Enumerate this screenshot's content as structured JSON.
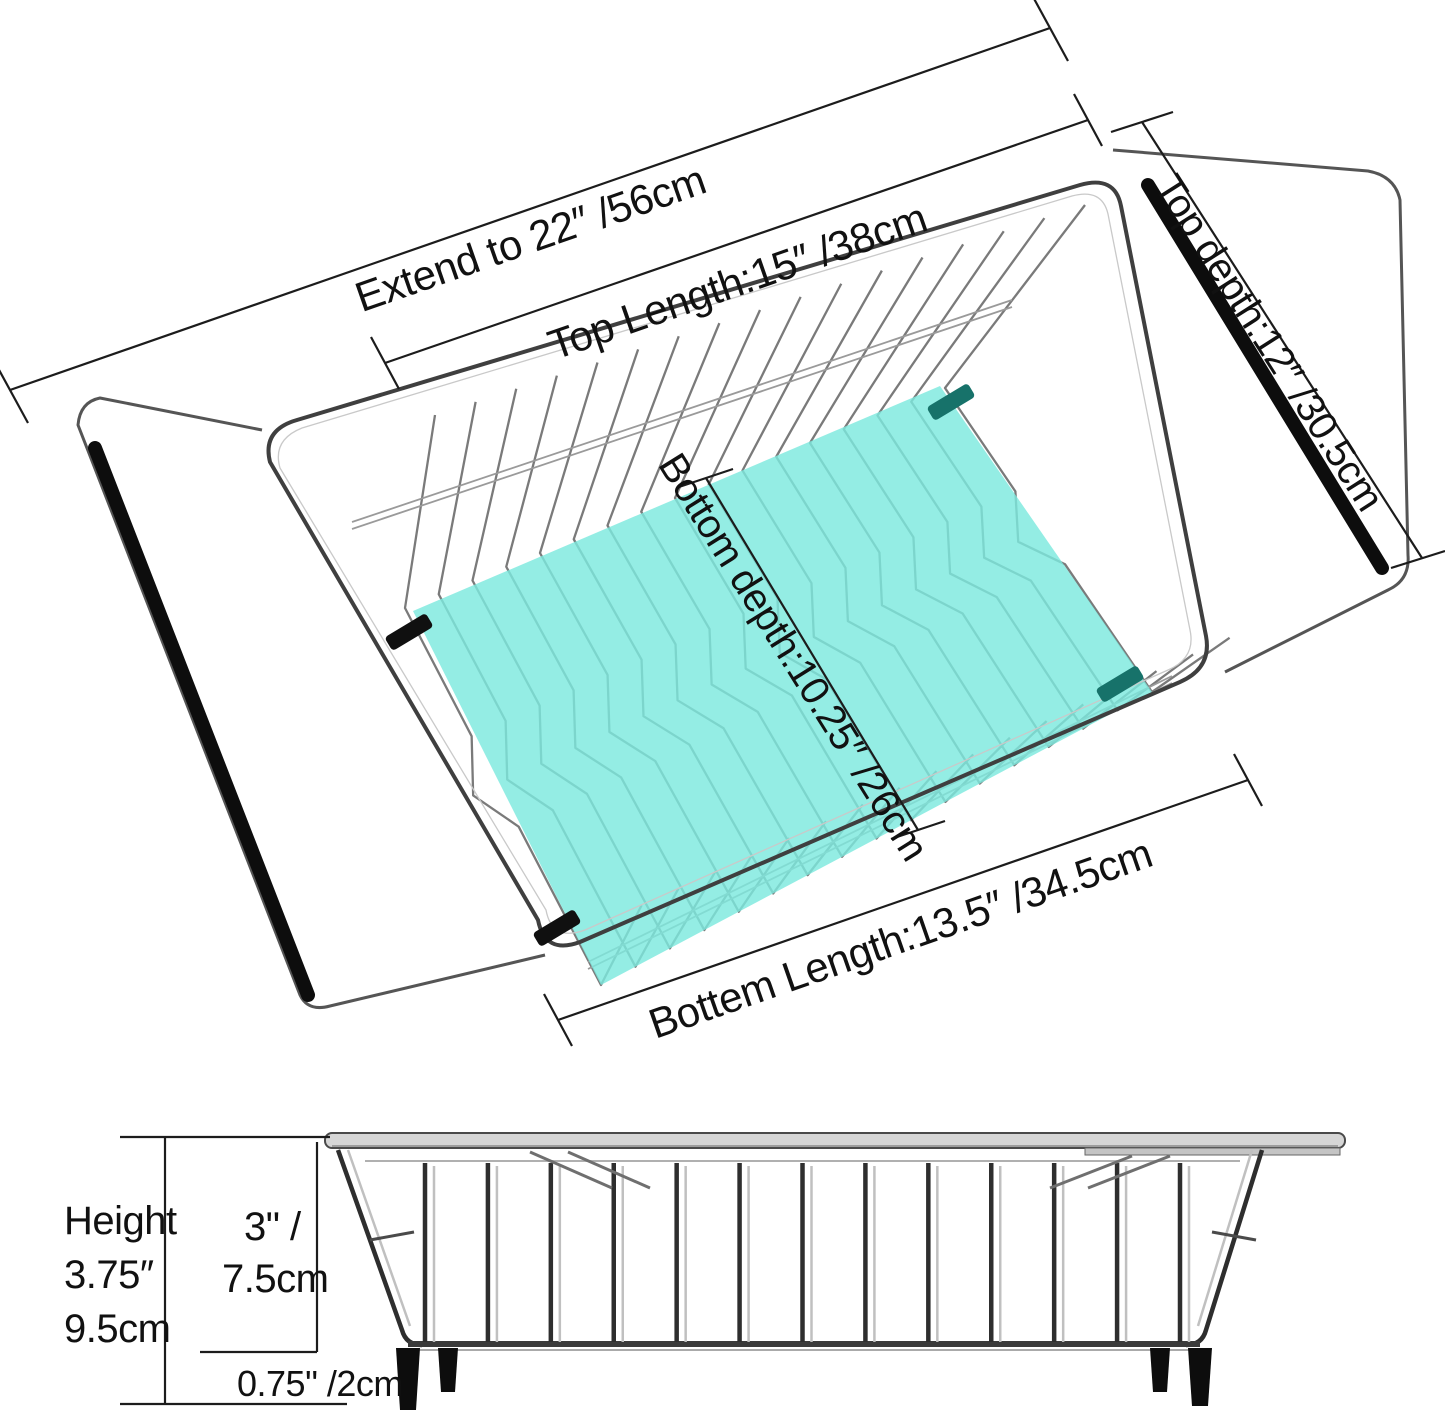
{
  "colors": {
    "background": "#ffffff",
    "highlight_teal": "#7de9de",
    "clip_teal_dark": "#17726a",
    "grip_black": "#0d0d0d",
    "wire_gray": "#7a7a7a",
    "line_black": "#1c1c1c"
  },
  "top_view": {
    "labels": {
      "extend": "Extend to 22″ /56cm",
      "top_length": "Top Length:15″ /38cm",
      "top_depth": "Top depth:12″ /30.5cm",
      "bottom_depth": "Bottom depth:10.25″ /26cm",
      "bottom_length": "Bottem Length:13.5″ /34.5cm"
    }
  },
  "side_view": {
    "labels": {
      "height_word": "Height",
      "height_inches": "3.75″",
      "height_cm": "9.5cm",
      "inner_height_inches": "3\" /",
      "inner_height_cm": "7.5cm",
      "feet_height": "0.75\" /2cm"
    }
  }
}
